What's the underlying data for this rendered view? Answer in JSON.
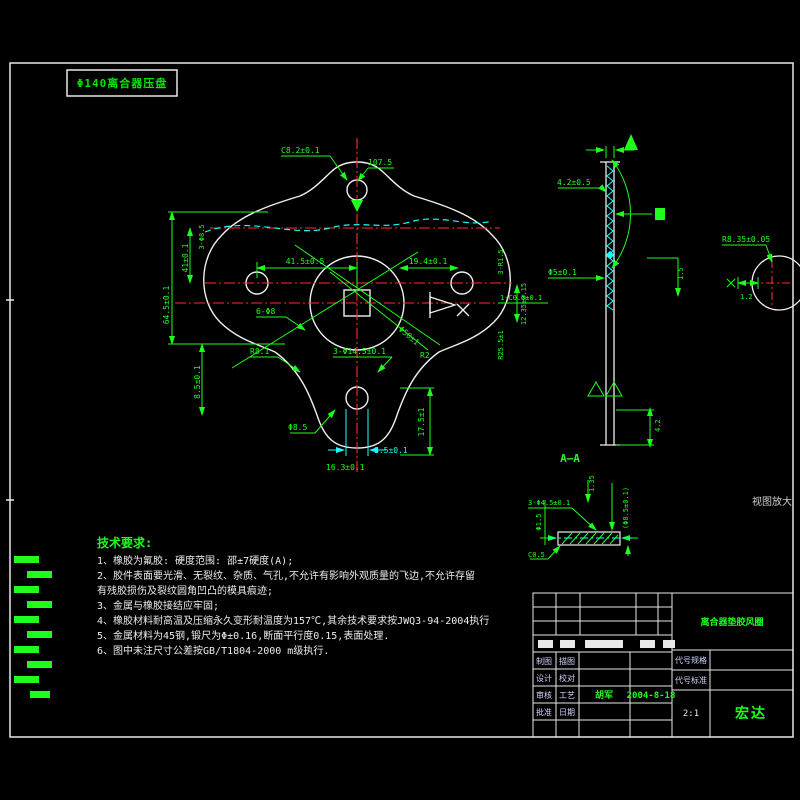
{
  "window": {
    "header_label": "Φ140离合器压盘",
    "view_note": "视图放大",
    "section_label": "A—A"
  },
  "colors": {
    "green": "#1eff1e",
    "red": "#ff2d2d",
    "cyan": "#1affff",
    "white": "#f0f0f0",
    "background": "#000000"
  },
  "tech_requirements": {
    "title": "技术要求:",
    "lines": [
      "1、橡胶为氟胶: 硬度范围: 邵±7硬度(A);",
      "2、胶件表面要光滑、无裂纹、杂质、气孔,不允许有影响外观质量的飞边,不允许存留",
      "有残胶损伤及裂纹圆角凹凸的模具痕迹;",
      "3、金属与橡胶接结应牢固;",
      "4、橡胶材料耐高温及压缩永久变形耐温度为157℃,其余技术要求按JWQ3-94-2004执行",
      "5、金属材料为45钢,锻尺为Φ±0.16,断面平行度0.15,表面处理.",
      "6、图中未注尺寸公差按GB/T1804-2000  m级执行."
    ]
  },
  "dims": {
    "top_chamfer": "C8.2±0.1",
    "top_height": "107.5",
    "left_outer": "64.5±0.1",
    "left_inner": "41±0.1",
    "left_top": "3-Φ8.5",
    "left_lower": "8.5±0.1",
    "mid_left": "41.5±0.5",
    "mid_right": "19.4±0.1",
    "center_dia": "Φ50±1",
    "holes": "6-Φ8",
    "right_r": "3-R1.5",
    "right_chamfer": "1-C0.5±0.1",
    "right_r2": "R25.5±1",
    "right_offset": "12.35±0.15",
    "bottom_r": "R8.1",
    "bottom_holes": "3-Φ14.5±0.1",
    "bottom_r2": "R2",
    "bottom_dia": "Φ8.5",
    "bottom_height": "17.5±1",
    "bottom_cyan": "8.5±0.1",
    "bottom_low": "16.3±0.1"
  },
  "section_dims": {
    "top_w": "4.2±0.5",
    "mid_dia": "Φ5±0.1",
    "corner": "1.5",
    "thickness": "4.2"
  },
  "detail_dims": {
    "holes": "3-Φ4.5±0.1",
    "t": "1.35",
    "dia": "(Φ8.5±0.1)",
    "left": "Φ1.5",
    "chamfer": "C0.5"
  },
  "right_detail": {
    "r": "R8.35±0.05",
    "w": "1.2"
  },
  "titleblock": {
    "part_name": "离合器垫胶风圈",
    "rows": [
      {
        "l": "制图",
        "l2": "描图",
        "name": "",
        "date": ""
      },
      {
        "l": "设计",
        "l2": "校对",
        "name": "",
        "date": ""
      },
      {
        "l": "审核",
        "l2": "工艺",
        "name": "胡军",
        "date": "2004-8-18"
      },
      {
        "l": "批准",
        "l2": "日期",
        "name": "",
        "date": ""
      }
    ],
    "spec1": "代号规格",
    "spec2": "代号标准",
    "scale": "2:1",
    "company": "宏达"
  }
}
